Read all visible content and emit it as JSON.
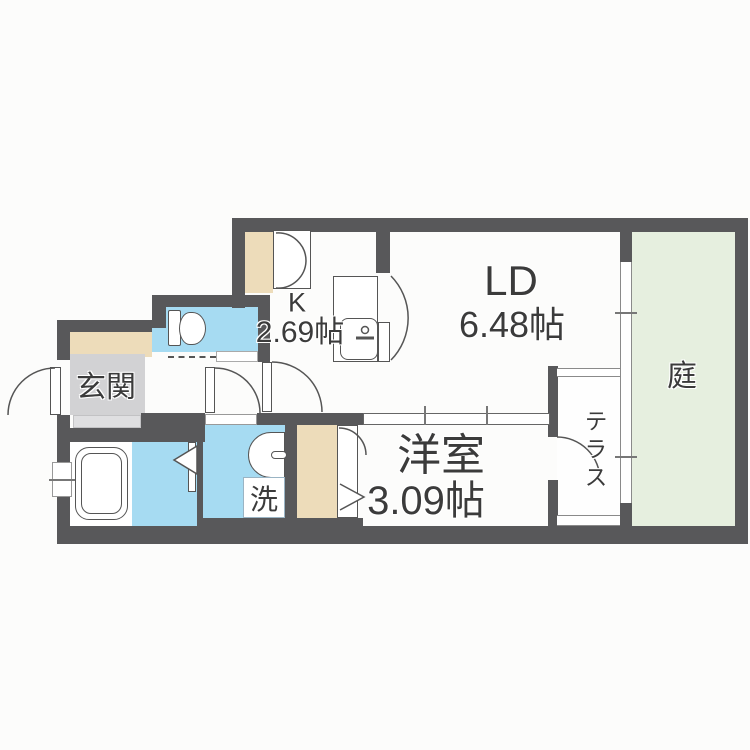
{
  "rooms": {
    "living_dining": {
      "label": "LD",
      "area": "6.48帖"
    },
    "kitchen": {
      "label": "K",
      "area": "2.69帖"
    },
    "western_room": {
      "label": "洋室",
      "area": "3.09帖"
    },
    "entrance": {
      "label": "玄関"
    },
    "garden": {
      "label": "庭"
    },
    "terrace": {
      "label": "テラス"
    },
    "laundry": {
      "label": "洗"
    }
  },
  "colors": {
    "wall": "#58585a",
    "blue": "#a6dbf2",
    "beige": "#eddcba",
    "gray": "#d2d2d4",
    "step": "#dfdfe1",
    "garden": "#e6efdf",
    "floor": "#fdfdfc",
    "line": "#666666",
    "text": "#3b3b3b",
    "bg": "#fcfcfb"
  }
}
